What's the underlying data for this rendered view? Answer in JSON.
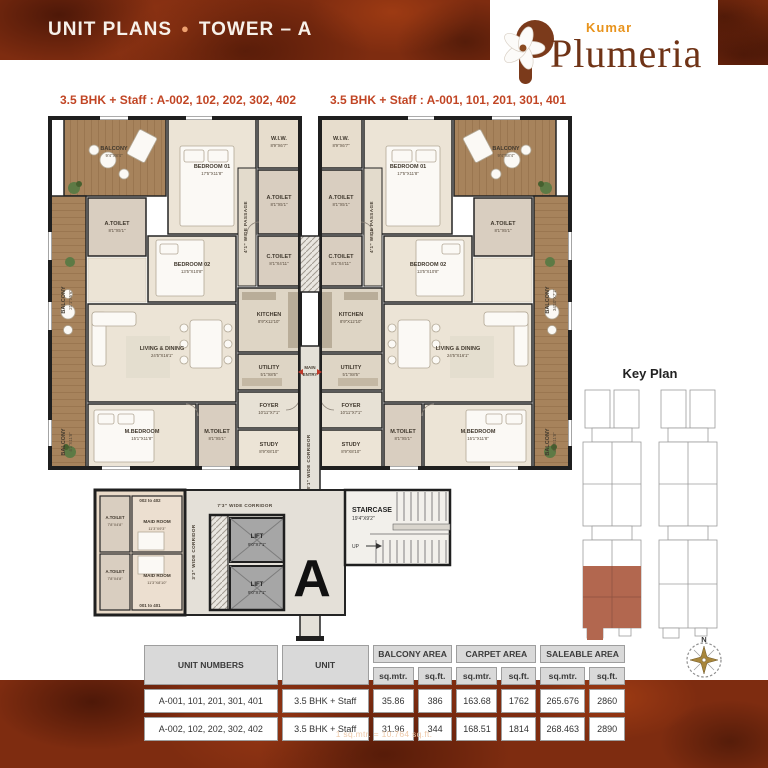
{
  "header": {
    "title_left": "UNIT PLANS",
    "title_right": "TOWER – A",
    "brand_top": "Kumar",
    "brand_name": "Plumeria"
  },
  "subtitles": {
    "left": "3.5 BHK + Staff : A-002, 102, 202, 302, 402",
    "right": "3.5 BHK + Staff : A-001, 101, 201, 301, 401"
  },
  "plan": {
    "rooms": {
      "balcony_top": {
        "name": "BALCONY",
        "dim": "9'4\"X8'4\""
      },
      "bedroom1": {
        "name": "BEDROOM 01",
        "dim": "17'5\"X11'8\""
      },
      "wiw": {
        "name": "W.I.W.",
        "dim": "8'9\"X6'7\""
      },
      "atoilet": {
        "name": "A.TOILET",
        "dim": "8'1\"X5'1\""
      },
      "bedroom2": {
        "name": "BEDROOM 02",
        "dim": "13'5\"X10'8\""
      },
      "ctoilet": {
        "name": "C.TOILET",
        "dim": "8'1\"X4'11\""
      },
      "kitchen": {
        "name": "KITCHEN",
        "dim": "8'9\"X12'10\""
      },
      "living": {
        "name": "LIVING & DINING",
        "dim": "24'5\"X16'1\""
      },
      "utility": {
        "name": "UTILITY",
        "dim": "5'1\"X8'5\""
      },
      "foyer": {
        "name": "FOYER",
        "dim": "10'11\"X7'1\""
      },
      "study": {
        "name": "STUDY",
        "dim": "8'9\"X8'10\""
      },
      "mtoilet": {
        "name": "M.TOILET",
        "dim": "8'1\"X5'1\""
      },
      "mbedroom": {
        "name": "M.BEDROOM",
        "dim": "15'1\"X11'8\""
      },
      "balcony_left": {
        "name": "BALCONY",
        "dim": "21'1\"X5'6\""
      },
      "balcony_right": {
        "name": "BALCONY",
        "dim": "34'10\"X7'1\""
      },
      "balcony_low": {
        "name": "BALCONY",
        "dim": "4'1\"X11'8\""
      }
    },
    "corridors": {
      "main": "8'1\" WIDE CORRIDOR",
      "lobby": "7'3\" WIDE CORRIDOR",
      "maid": "3'3\" WIDE CORRIDOR",
      "passage": "4'1\" WIDE PASSAGE"
    },
    "entry": {
      "line1": "MAIN",
      "line2": "ENTRY"
    },
    "core": {
      "maid_range_top": "002 to 402",
      "maid_range_bottom": "001 to 401",
      "maid_room1": {
        "name": "MAID ROOM",
        "dim": "11'3\"X9'3\""
      },
      "maid_room2": {
        "name": "MAID ROOM",
        "dim": "11'3\"X8'10\""
      },
      "maid_toilet": {
        "name": "A.TOILET",
        "dim": "7'8\"X4'8\""
      },
      "lift": {
        "name": "LIFT",
        "dim": "9'0\"X7'1\""
      },
      "staircase": {
        "name": "STAIRCASE",
        "dim": "19'4\"X9'2\""
      },
      "up": "UP",
      "tower_letter": "A"
    }
  },
  "key_plan": {
    "title": "Key Plan"
  },
  "compass": {
    "north": "N"
  },
  "table": {
    "col_units": "UNIT NUMBERS",
    "col_unit": "UNIT",
    "group_balcony": "BALCONY AREA",
    "group_carpet": "CARPET AREA",
    "group_saleable": "SALEABLE AREA",
    "sub_sqmtr": "sq.mtr.",
    "sub_sqft": "sq.ft.",
    "rows": [
      {
        "units": "A-001, 101, 201, 301, 401",
        "unit": "3.5 BHK + Staff",
        "balcony_sqmtr": "35.86",
        "balcony_sqft": "386",
        "carpet_sqmtr": "163.68",
        "carpet_sqft": "1762",
        "saleable_sqmtr": "265.676",
        "saleable_sqft": "2860"
      },
      {
        "units": "A-002, 102, 202, 302, 402",
        "unit": "3.5 BHK + Staff",
        "balcony_sqmtr": "31.96",
        "balcony_sqft": "344",
        "carpet_sqmtr": "168.51",
        "carpet_sqft": "1814",
        "saleable_sqmtr": "268.463",
        "saleable_sqft": "2890"
      }
    ]
  },
  "footer": {
    "note": "1 sq.mtr. = 10.764 sq.ft."
  },
  "colors": {
    "band": "#7e2c10",
    "subtitle": "#c14524",
    "logo_orange": "#e8931c",
    "logo_brown": "#6f3316",
    "keyplan_highlight": "#b2674f"
  }
}
